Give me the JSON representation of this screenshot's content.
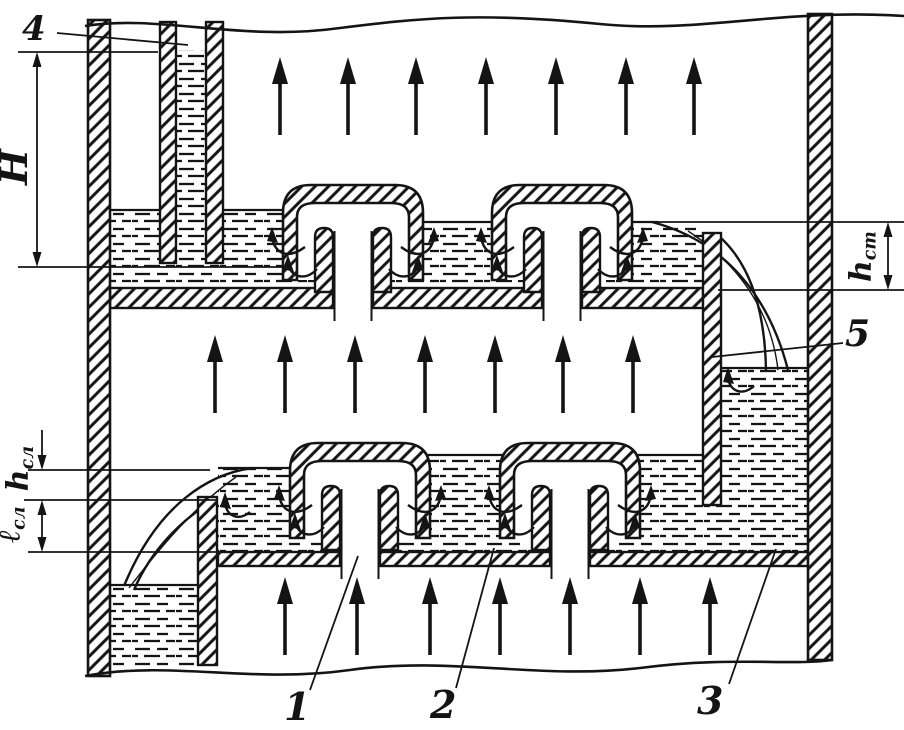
{
  "figure": {
    "callouts": {
      "n1": "1",
      "n2": "2",
      "n3": "3",
      "n4": "4",
      "n5": "5"
    },
    "dims": {
      "H": "H",
      "h_st_base": "h",
      "h_st_sub": "ст",
      "h_sl_base": "h",
      "h_sl_sub": "сл",
      "l_sl_base": "ℓ",
      "l_sl_sub": "сл"
    },
    "colors": {
      "ink": "#141414",
      "paper": "#ffffff"
    }
  }
}
